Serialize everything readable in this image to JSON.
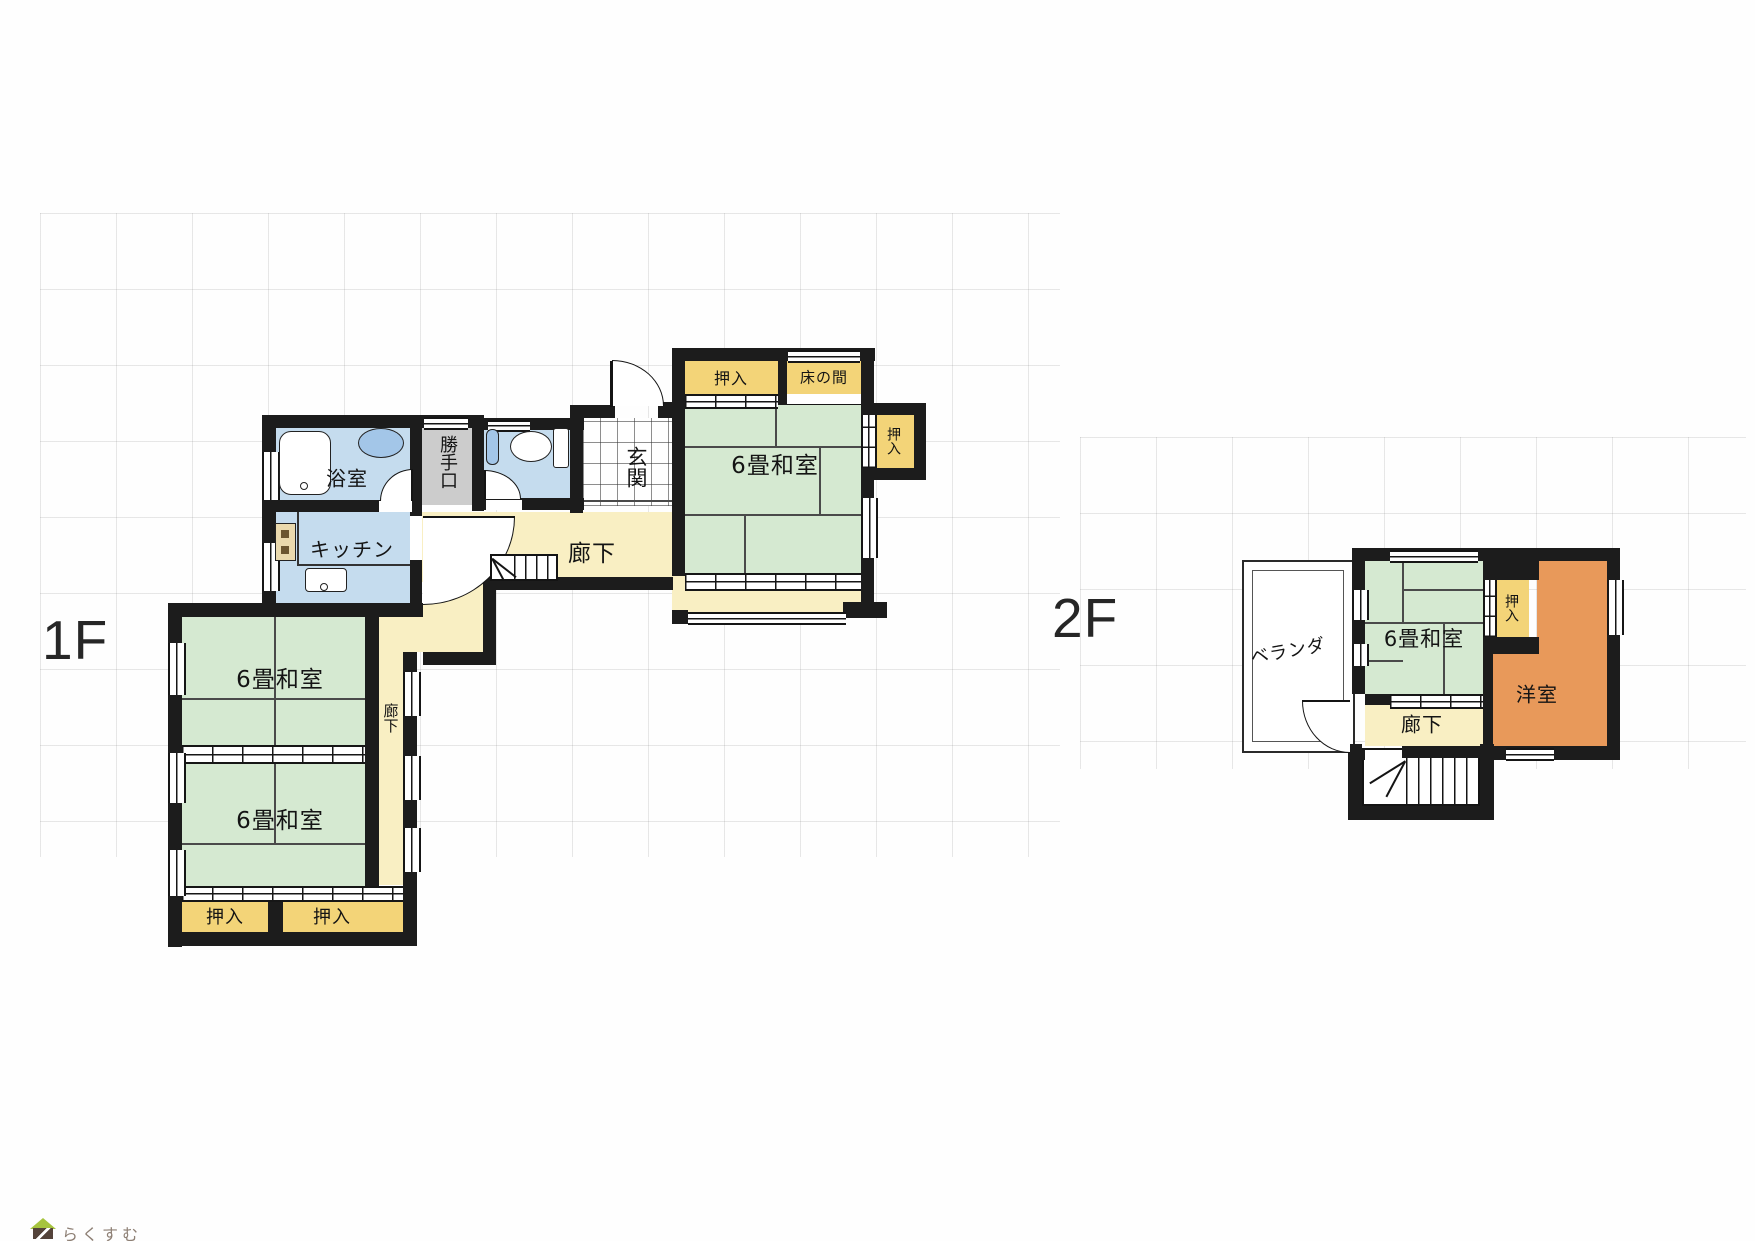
{
  "floors": {
    "f1": {
      "label": "1F",
      "rooms": {
        "bath": "浴室",
        "backdoor": "勝手口",
        "kitchen": "キッチン",
        "entrance": "玄関",
        "hall": "廊下",
        "hall_side": "廊下",
        "tatami_main": "6畳和室",
        "tatami_a": "6畳和室",
        "tatami_b": "6畳和室",
        "tokonoma": "床の間",
        "closet_top": "押入",
        "closet_side": "押入",
        "closet_bl": "押入",
        "closet_br": "押入"
      }
    },
    "f2": {
      "label": "2F",
      "rooms": {
        "veranda": "ベランダ",
        "tatami": "6畳和室",
        "closet": "押入",
        "western": "洋室",
        "hall": "廊下"
      }
    },
    "logo": {
      "text": "らくすむ"
    }
  },
  "colors": {
    "wall": "#1c1c1c",
    "tatami": "#d5e9d1",
    "closet": "#f3d478",
    "corridor": "#f9efc3",
    "water": "#c5dcee",
    "fixture": "#a3c6e8",
    "gray": "#cccccc",
    "western": "#e8995a",
    "logo_green": "#a6c43e",
    "logo_brown": "#54433a",
    "logo_text": "#8d7f74"
  }
}
